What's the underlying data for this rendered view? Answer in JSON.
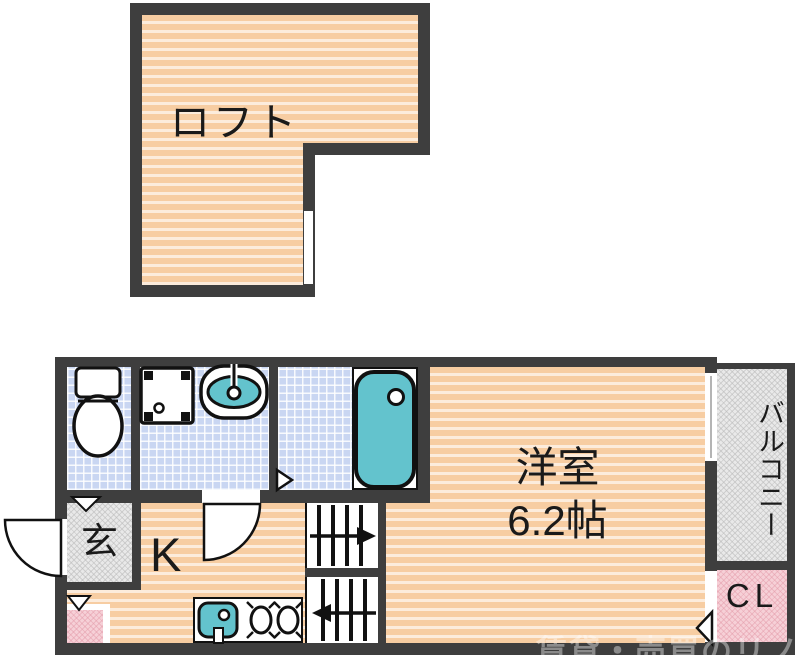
{
  "loft": {
    "label": "ロフト"
  },
  "rooms": {
    "western_room": {
      "label": "洋室",
      "size": "6.2帖"
    },
    "kitchen": {
      "label": "K"
    },
    "entrance": {
      "label": "玄"
    },
    "balcony": {
      "label": "バルコニー"
    },
    "closet": {
      "label": "CL"
    }
  },
  "stairs": {
    "upper_arrow": "right",
    "lower_arrow": "left"
  },
  "watermark": "賃貸・売買のリノベ",
  "colors": {
    "wall": "#3e3e3e",
    "floor_wood": "#f7cda2",
    "tile_blue": "#c9d6f2",
    "fixture_teal": "#63c3cd",
    "hatch_gray": "#e9e9e9",
    "closet_pink": "#f6d0d7"
  }
}
